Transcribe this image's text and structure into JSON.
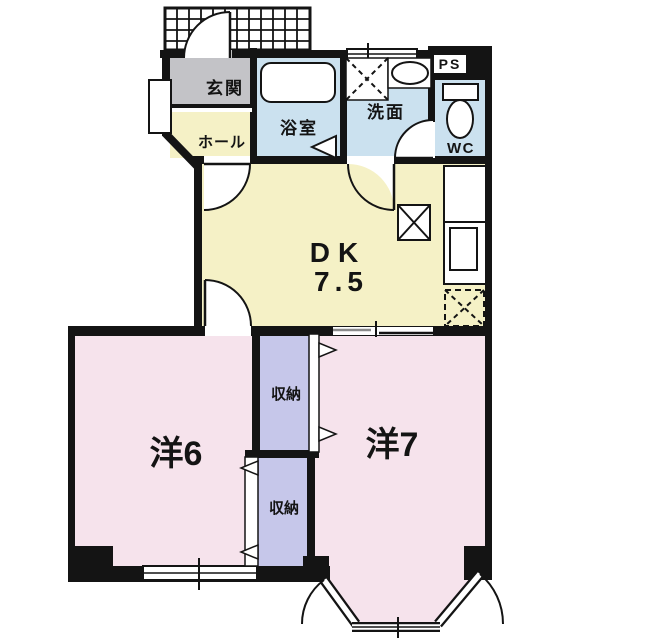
{
  "floor_plan": {
    "labels": {
      "genkan": "玄関",
      "hall": "ホール",
      "bathroom": "浴室",
      "washroom": "洗面",
      "wc": "WC",
      "ps": "PS",
      "dk_name": "DK",
      "dk_size": "7.5",
      "room6": "洋6",
      "room7": "洋7",
      "storage_upper": "収納",
      "storage_lower": "収納"
    },
    "colors": {
      "wall": "#141414",
      "dk": "#F5F1C6",
      "rooms": "#F6E3EC",
      "storage": "#C6C7EA",
      "wet_area": "#CBE1EF",
      "entrance": "#C3C3C7",
      "background": "#FFFFFF"
    }
  }
}
